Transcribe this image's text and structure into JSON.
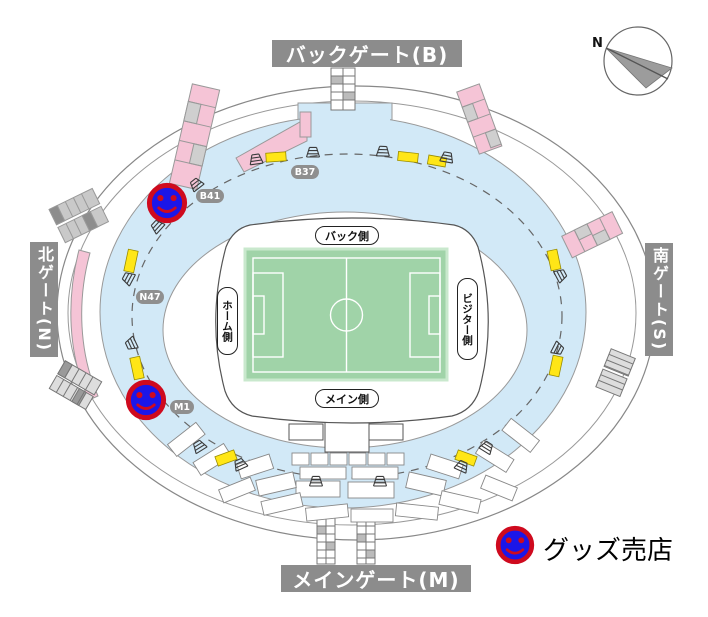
{
  "gates": {
    "back": {
      "label": "バックゲート(B)"
    },
    "main": {
      "label": "メインゲート(M)"
    },
    "north": {
      "label": "北ゲート(N)"
    },
    "south": {
      "label": "南ゲート(S)"
    }
  },
  "stands": {
    "back": "バック側",
    "main": "メイン側",
    "home": "ホーム側",
    "visitor": "ビジター側"
  },
  "gate_numbers": {
    "b37": "B37",
    "b41": "B41",
    "n47": "N47",
    "m1": "M1"
  },
  "legend": {
    "goods_shop_label": "グッズ売店"
  },
  "compass": {
    "north_label": "N"
  },
  "goods_shops": {
    "count": 2
  },
  "icons": {
    "goods_shop": "smiley-face-icon",
    "stairs": "stairs-icon",
    "north_arrow": "compass-north-arrow-icon"
  },
  "colors": {
    "concourse_blue": "#d2e9f7",
    "pitch_green": "#a0d3a8",
    "pitch_border": "#c9e8cd",
    "ramp_pink": "#f5c4d6",
    "kiosk_yellow": "#ffe617",
    "gate_label_gray": "#8c8c8c",
    "badge_gray": "#8f8f8f",
    "shop_blue": "#1b16e8",
    "shop_red": "#cf0a1e"
  }
}
